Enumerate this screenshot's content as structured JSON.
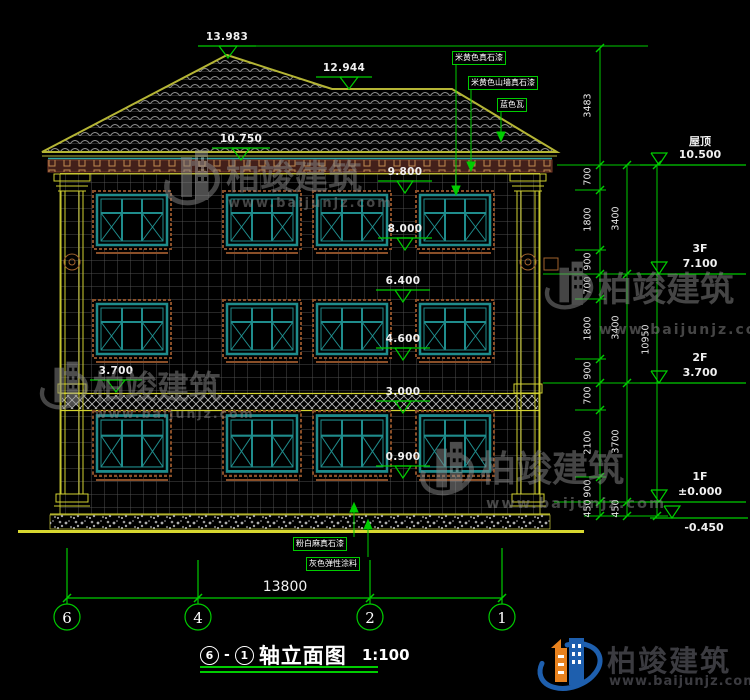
{
  "title_block": {
    "axis_from": "6",
    "axis_to": "1",
    "name": "轴立面图",
    "scale": "1:100"
  },
  "grid_bubbles": [
    "6",
    "4",
    "2",
    "1"
  ],
  "bottom_dim": "13800",
  "levels": [
    {
      "name": "屋顶",
      "value": "10.500"
    },
    {
      "name": "3F",
      "value": "7.100"
    },
    {
      "name": "2F",
      "value": "3.700"
    },
    {
      "name": "1F",
      "value": "±0.000"
    },
    {
      "name": "",
      "value": "-0.450"
    }
  ],
  "spot_elevations": [
    "13.983",
    "12.944",
    "10.750",
    "9.800",
    "8.000",
    "6.400",
    "4.600",
    "3.700",
    "3.000",
    "0.900"
  ],
  "dims": {
    "tier1": [
      "3483",
      "700",
      "1800",
      "900",
      "700",
      "1800",
      "900",
      "700",
      "2100",
      "900",
      "450"
    ],
    "tier2": [
      "3400",
      "3400",
      "3700",
      "450"
    ],
    "tier3": [
      "10950"
    ]
  },
  "notes_top": [
    "米黄色真石漆",
    "米黄色山墙真石漆",
    "蓝色瓦"
  ],
  "notes_bottom": [
    "粉白麻真石漆",
    "灰色弹性涂料"
  ],
  "watermark": {
    "name": "柏竣建筑",
    "url": "www.baijunjz.com"
  },
  "logo": {
    "name": "柏竣建筑",
    "url": "www.baijunjz.com"
  },
  "colors": {
    "dim_green": "#00cc00",
    "outline_yellow": "#b5b535",
    "window_teal": "#1f8c8c"
  }
}
